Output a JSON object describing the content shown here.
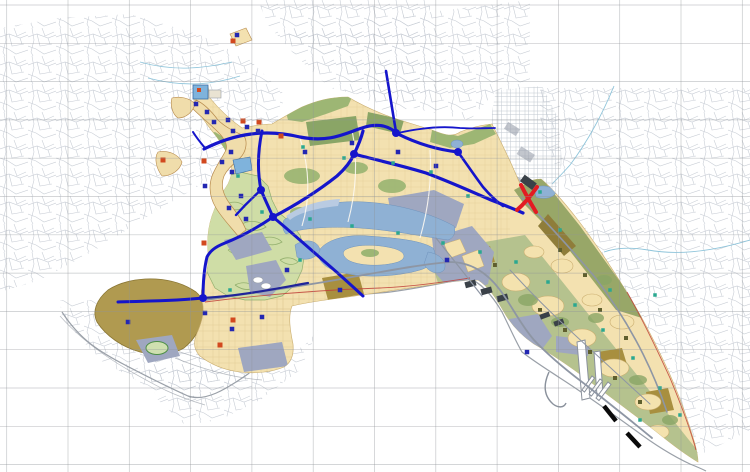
{
  "title": "Urban master plan zoning map with road network, coastline and harbor",
  "colors": {
    "bg": "#ffffff",
    "grid": "#8f9398",
    "cad": "#c9ced6",
    "cad_city": "#b8bfc8",
    "tan": "#f3e1b0",
    "tan_patch": "#f4e2ae",
    "tan_line": "#c9ad6f",
    "sage": "#9db674",
    "sage_dark": "#8aa566",
    "sage_band": "#98a768",
    "se_green": "#b5c28e",
    "golf": "#cfdda6",
    "golf_line": "#93b06e",
    "khaki": "#a88f3f",
    "khaki_dark": "#8f7d3a",
    "blob": "#b09a50",
    "blob_line": "#8a7634",
    "lavender": "#9fa7c0",
    "water": "#8fb1d4",
    "water_light": "#b9cbe2",
    "water_bright": "#7fb3dc",
    "water_line": "#6f93bc",
    "road_blue": "#1515cb",
    "road_navy": "#20249a",
    "road_gray": "#8e96a4",
    "minor_white": "#fdfaf2",
    "coast": "#9aa0a8",
    "boundary_red": "#c04038",
    "creek": "#8ec4da",
    "red_accent": "#e31b22",
    "icon_blue": "#2327b2",
    "icon_red": "#d2491f",
    "icon_teal": "#2aa890",
    "icon_olive": "#5f5f2e",
    "hatch_dark": "#3a4148",
    "black": "#0a0a0a"
  },
  "map": {
    "width": 750,
    "height": 472,
    "grid": {
      "x_start": 6.7,
      "x_step": 61.3,
      "y_start": 5,
      "y_step": 38.3
    },
    "icon_sizes": {
      "blue": 4.5,
      "red": 5,
      "teal": 3.5,
      "olive": 4
    },
    "roads_blue": [
      {
        "d": "M204,149 C236,133 266,129 300,137 C330,143 346,133 362,128 C380,122 390,127 398,134 C420,145 440,150 458,152",
        "w": 3.2
      },
      {
        "d": "M386,71 L396,132",
        "w": 2.6
      },
      {
        "d": "M398,133 C420,128 442,126 460,128 C474,129 486,128 495,128",
        "w": 1.8
      },
      {
        "d": "M262,131 C258,150 257,170 261,190 C266,202 270,210 273,217",
        "w": 3.0
      },
      {
        "d": "M261,190 C252,198 244,206 236,215",
        "w": 2.4
      },
      {
        "d": "M273,217 C294,206 318,191 337,176 C346,168 351,161 354,154 C358,146 361,139 363,131",
        "w": 3.2
      },
      {
        "d": "M354,154 C380,161 404,166 426,173 C448,181 470,191 491,200 C504,205 514,209 523,213",
        "w": 3.2
      },
      {
        "d": "M458,152 C466,163 474,175 483,187 C489,194 496,201 503,206",
        "w": 2.6
      },
      {
        "d": "M273,217 C257,228 240,237 225,243 C215,247 210,251 207,257 C204,269 203,283 203,298",
        "w": 3.0
      },
      {
        "d": "M203,298 C175,301 145,301 118,302",
        "w": 3.0
      },
      {
        "d": "M273,217 C291,232 309,248 325,262 C338,273 351,285 363,296",
        "w": 3.0
      },
      {
        "d": "M203,298 C240,296 274,289 308,283",
        "w": 2.2,
        "navy": true
      },
      {
        "d": "M205,148 C200,142 196,137 193,132",
        "w": 2.0
      }
    ],
    "roads_gray": [
      {
        "d": "M206,300 C250,293 300,287 352,277 C392,270 424,264 450,262 C472,262 488,274 500,290 C512,306 520,324 534,340 C548,355 566,370 586,385 C610,404 634,423 652,438",
        "w": 1.8
      },
      {
        "d": "M522,198 C545,220 570,248 594,276 C614,302 630,328 643,354 C653,374 661,394 667,412",
        "w": 1.6
      },
      {
        "d": "M436,238 C452,258 468,278 482,296",
        "w": 1.2
      },
      {
        "d": "M510,270 C530,292 552,314 576,336 C600,358 626,382 650,404",
        "w": 1.0
      }
    ],
    "node_dots": [
      [
        203,
        298
      ],
      [
        273,
        217
      ],
      [
        354,
        154
      ],
      [
        458,
        152
      ],
      [
        396,
        133
      ],
      [
        261,
        190
      ]
    ],
    "red_x": [
      "M521,185 C526,195 530,202 536,212",
      "M537,187 C530,197 524,204 517,210"
    ],
    "black_dashes": [
      "M604,406 L616,421",
      "M627,433 L640,447"
    ],
    "icons": {
      "blue": [
        [
          196,
          104
        ],
        [
          207,
          112
        ],
        [
          214,
          122
        ],
        [
          228,
          120
        ],
        [
          233,
          131
        ],
        [
          247,
          127
        ],
        [
          258,
          131
        ],
        [
          231,
          152
        ],
        [
          222,
          162
        ],
        [
          205,
          186
        ],
        [
          232,
          172
        ],
        [
          241,
          196
        ],
        [
          229,
          208
        ],
        [
          246,
          219
        ],
        [
          305,
          152
        ],
        [
          352,
          143
        ],
        [
          398,
          152
        ],
        [
          436,
          166
        ],
        [
          287,
          270
        ],
        [
          340,
          290
        ],
        [
          205,
          313
        ],
        [
          232,
          329
        ],
        [
          262,
          317
        ],
        [
          128,
          322
        ],
        [
          447,
          260
        ],
        [
          527,
          352
        ],
        [
          237,
          35
        ]
      ],
      "red": [
        [
          163,
          160
        ],
        [
          204,
          161
        ],
        [
          243,
          121
        ],
        [
          259,
          122
        ],
        [
          281,
          136
        ],
        [
          204,
          243
        ],
        [
          233,
          320
        ],
        [
          220,
          345
        ],
        [
          233,
          41
        ]
      ],
      "teal": [
        [
          303,
          147
        ],
        [
          344,
          158
        ],
        [
          393,
          163
        ],
        [
          431,
          172
        ],
        [
          468,
          196
        ],
        [
          238,
          176
        ],
        [
          310,
          219
        ],
        [
          352,
          226
        ],
        [
          398,
          233
        ],
        [
          443,
          243
        ],
        [
          480,
          252
        ],
        [
          516,
          262
        ],
        [
          548,
          282
        ],
        [
          575,
          305
        ],
        [
          603,
          330
        ],
        [
          633,
          358
        ],
        [
          660,
          388
        ],
        [
          300,
          260
        ],
        [
          262,
          212
        ],
        [
          230,
          290
        ],
        [
          560,
          230
        ],
        [
          610,
          290
        ],
        [
          655,
          295
        ],
        [
          680,
          415
        ],
        [
          640,
          420
        ],
        [
          540,
          192
        ]
      ],
      "olive": [
        [
          560,
          250
        ],
        [
          585,
          275
        ],
        [
          540,
          310
        ],
        [
          565,
          330
        ],
        [
          590,
          352
        ],
        [
          615,
          378
        ],
        [
          640,
          402
        ],
        [
          600,
          310
        ],
        [
          626,
          338
        ],
        [
          495,
          265
        ]
      ]
    }
  }
}
